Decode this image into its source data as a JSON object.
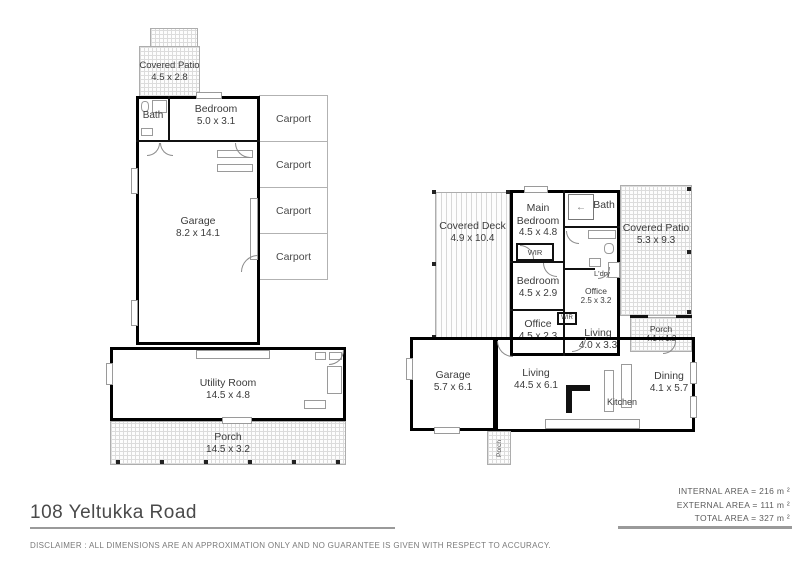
{
  "page": {
    "title": "108 Yeltukka Road",
    "disclaimer": "DISCLAIMER : ALL DIMENSIONS ARE AN APPROXIMATION ONLY AND NO GUARANTEE IS GIVEN WITH RESPECT TO ACCURACY."
  },
  "area_summary": {
    "internal": "INTERNAL AREA = 216 m ²",
    "external": "EXTERNAL AREA = 111 m ²",
    "total": "TOTAL AREA = 327 m ²"
  },
  "icons": {
    "shower_arrow": "←"
  },
  "left_building": {
    "covered_patio": {
      "name": "Covered Patio",
      "dims": "4.5 x 2.8"
    },
    "bath": {
      "name": "Bath"
    },
    "bedroom": {
      "name": "Bedroom",
      "dims": "5.0 x 3.1"
    },
    "garage": {
      "name": "Garage",
      "dims": "8.2 x 14.1"
    },
    "carport_label": "Carport",
    "utility": {
      "name": "Utility Room",
      "dims": "14.5 x 4.8"
    },
    "porch": {
      "name": "Porch",
      "dims": "14.5 x 3.2"
    }
  },
  "right_building": {
    "covered_deck": {
      "name": "Covered Deck",
      "dims": "4.9 x 10.4"
    },
    "main_bedroom": {
      "name": "Main Bedroom",
      "dims": "4.5 x 4.8"
    },
    "bath": {
      "name": "Bath"
    },
    "covered_patio": {
      "name": "Covered Patio",
      "dims": "5.3 x 9.3"
    },
    "wir1": {
      "name": "WIR"
    },
    "ldry": {
      "name": "L'dry"
    },
    "bedroom": {
      "name": "Bedroom",
      "dims": "4.5 x 2.9"
    },
    "office_small": {
      "name": "Office",
      "dims": "2.5 x 3.2"
    },
    "office": {
      "name": "Office",
      "dims": "4.5 x 2.3"
    },
    "wir2": {
      "name": "WIR"
    },
    "living_small": {
      "name": "Living",
      "dims": "4.0 x 3.3"
    },
    "porch_top": {
      "name": "Porch",
      "dims": "4.1 x 1.2"
    },
    "garage": {
      "name": "Garage",
      "dims": "5.7 x 6.1"
    },
    "living": {
      "name": "Living",
      "dims": "44.5 x 6.1"
    },
    "kitchen": {
      "name": "Kitchen"
    },
    "dining": {
      "name": "Dining",
      "dims": "4.1 x 5.7"
    },
    "porch_small": {
      "name": "Porch"
    }
  }
}
